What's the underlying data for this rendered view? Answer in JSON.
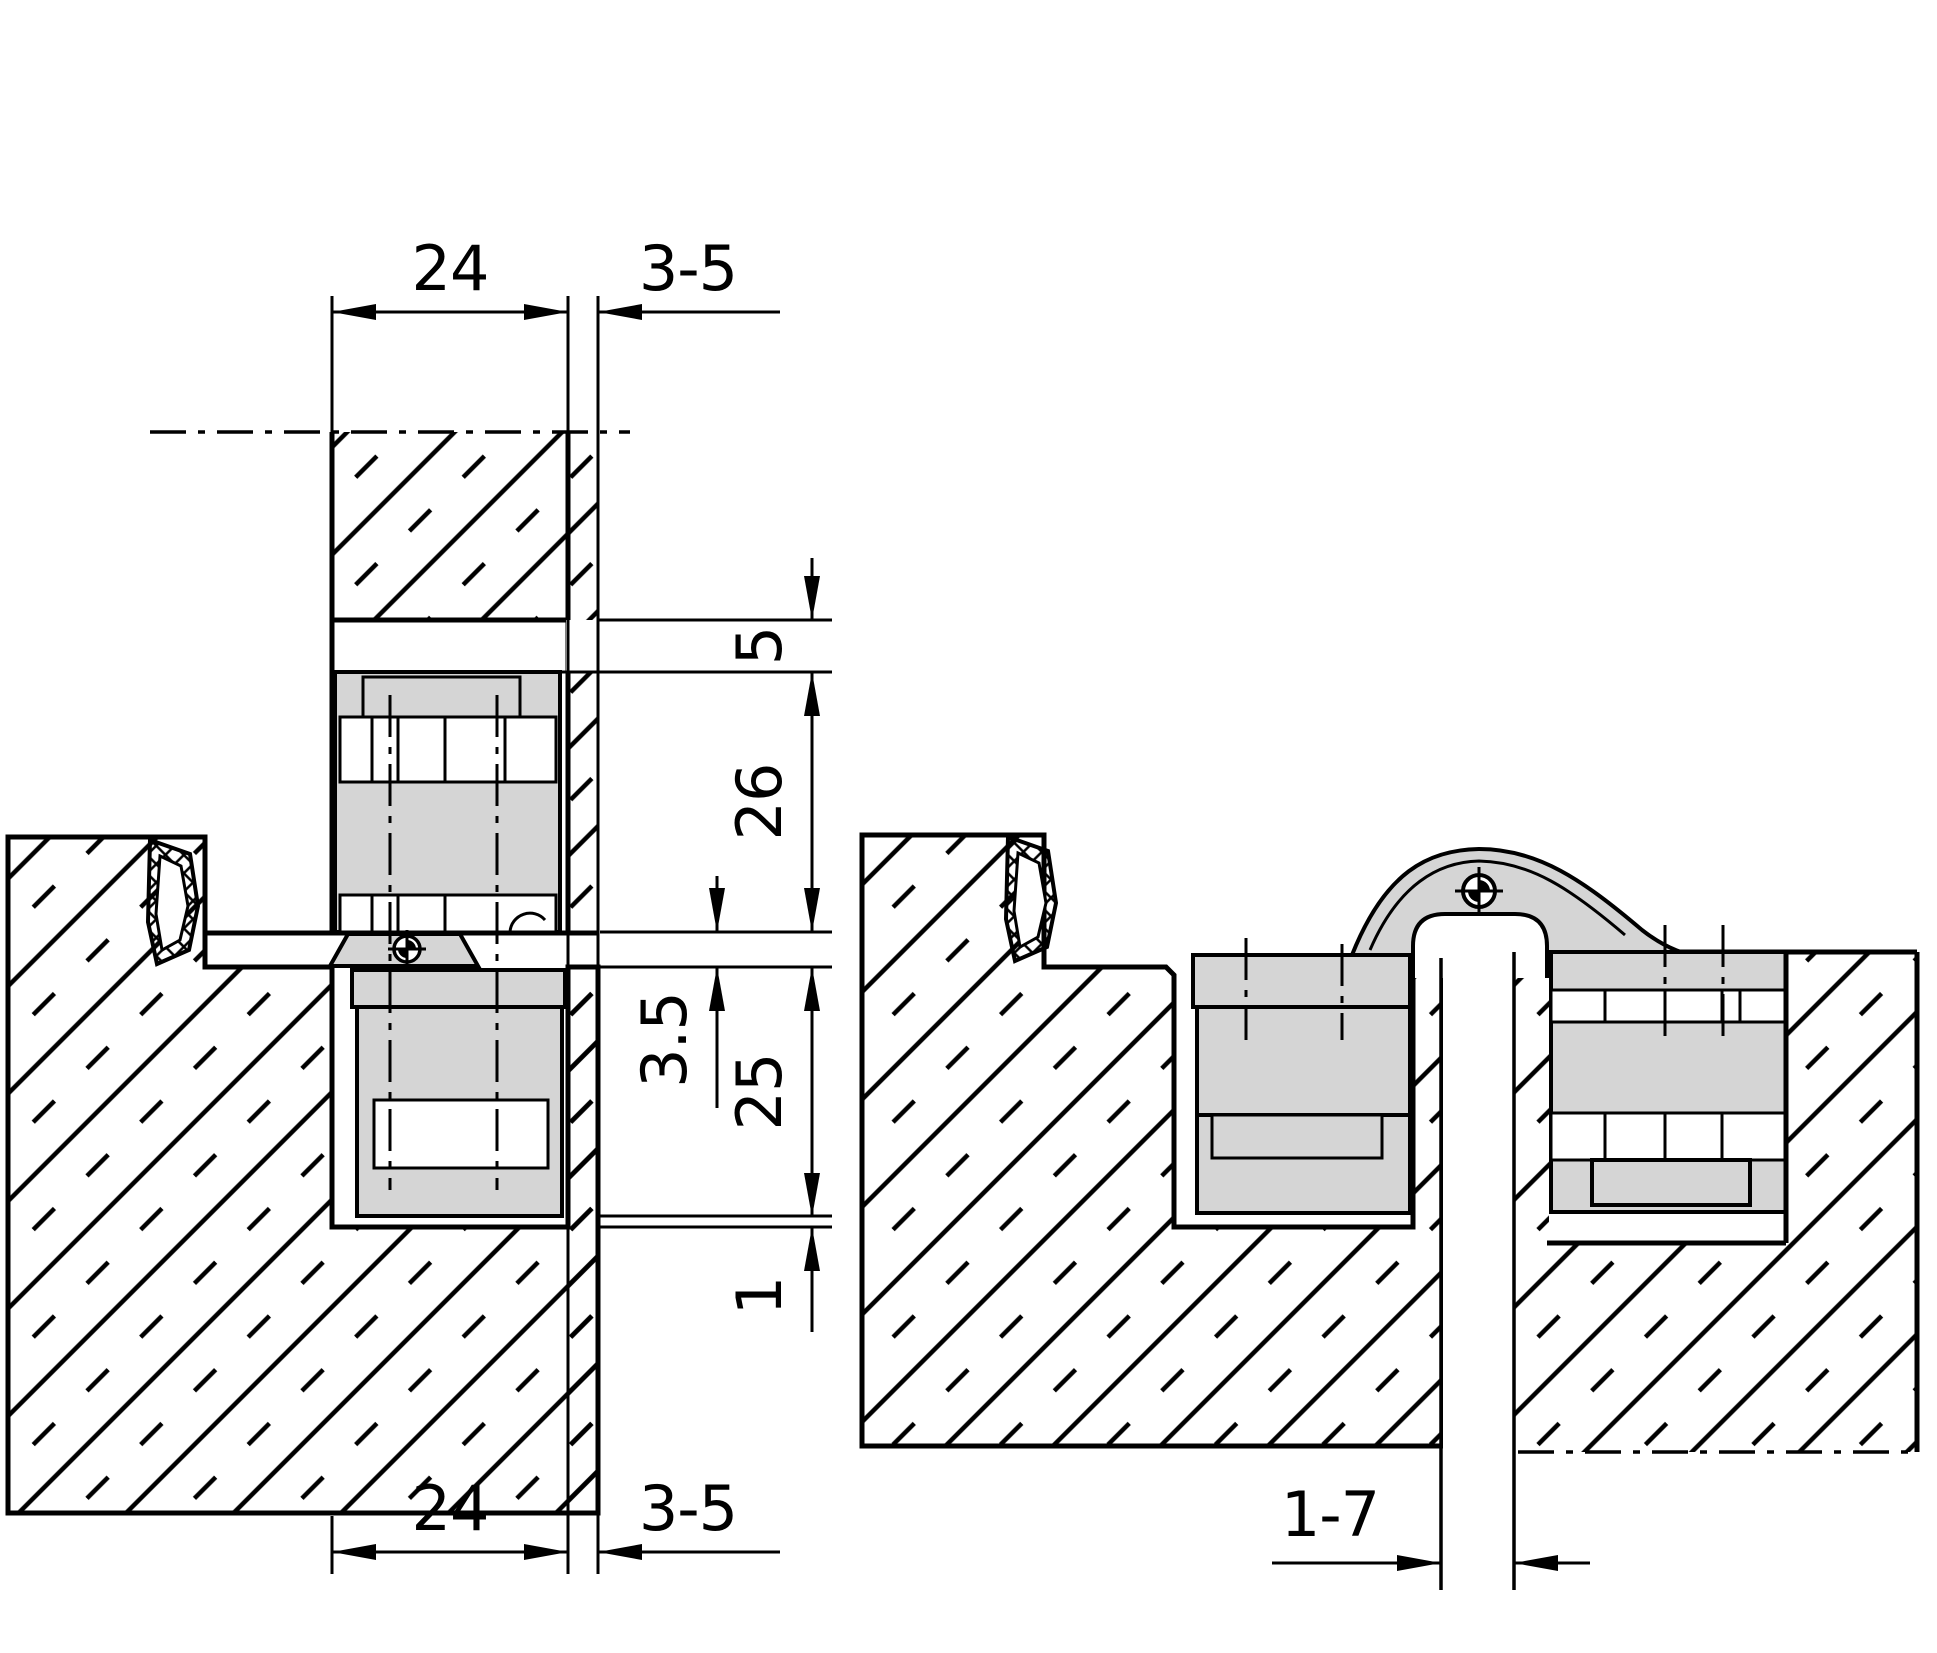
{
  "page": {
    "background": "#ffffff"
  },
  "drawing": {
    "line_color": "#000000",
    "hardware_fill": "#d5d5d5",
    "views": {
      "closed": {
        "label": "closed-position-section",
        "dims": {
          "door_thickness_top": "24",
          "air_gap_top": "3-5",
          "edge_inset": "5",
          "door_housing_depth": "26",
          "pivot_clearance": "3.5",
          "frame_housing_depth": "25",
          "bottom_clearance": "1",
          "door_thickness_bottom": "24",
          "air_gap_bottom": "3-5"
        }
      },
      "open": {
        "label": "open-position-section",
        "dims": {
          "rebate_gap": "1-7"
        }
      }
    }
  }
}
